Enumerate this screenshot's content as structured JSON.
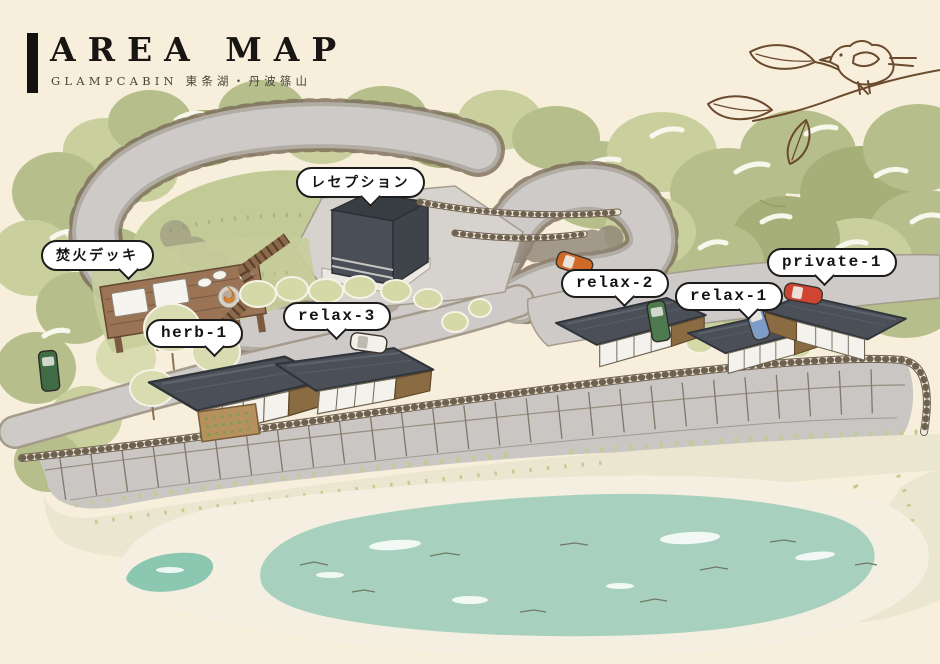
{
  "page": {
    "width": 940,
    "height": 664,
    "background": "#f7efdc"
  },
  "header": {
    "title": "AREA MAP",
    "subtitle": "GLAMPCABIN 東条湖・丹波篠山"
  },
  "labels": {
    "reception": "レセプション",
    "bonfire_deck": "焚火デッキ",
    "herb1": "herb-1",
    "relax3": "relax-3",
    "relax2": "relax-2",
    "relax1": "relax-1",
    "private1": "private-1"
  },
  "icons": {
    "bird": "bird-on-branch-icon",
    "bonfire": "bonfire-icon"
  },
  "colors": {
    "background": "#f7efdc",
    "forest_green": "#b6bf8b",
    "forest_green_dark": "#a6af77",
    "forest_green_light": "#c9d09d",
    "road_gray": "#cdcac7",
    "roof_charcoal": "#4b5058",
    "deck_brown": "#9b7355",
    "lake_teal": "#a7d1be",
    "label_border": "#1c1c1c",
    "sketch_brown": "#6b4a2e"
  }
}
